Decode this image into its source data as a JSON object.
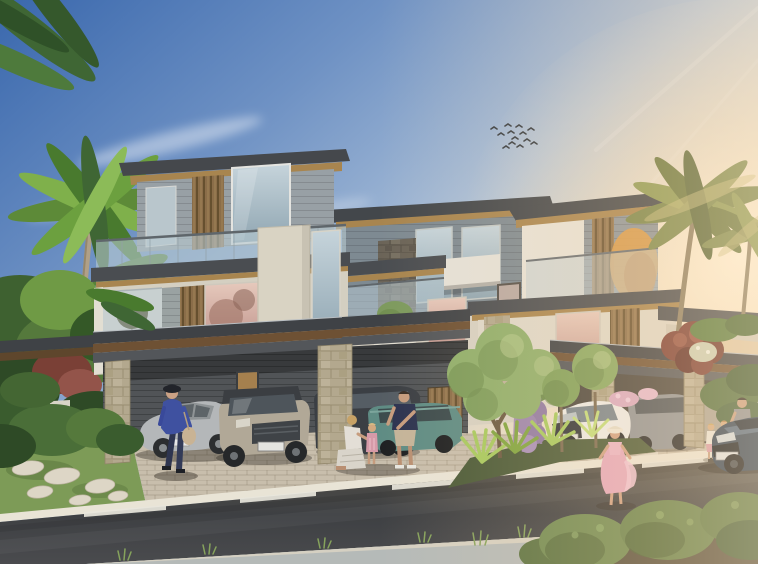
{
  "meta": {
    "type": "architectural-exterior-rendering",
    "subject": "contemporary twin luxury villas at sunset with street scene",
    "width_px": 758,
    "height_px": 564
  },
  "palette": {
    "sky-top": "#3a68ad",
    "sky-mid": "#a9bed7",
    "sky-horizon": "#f0e0c8",
    "sun-glow": "#fff3dc",
    "roof-dark": "#43474b",
    "fascia-dark": "#4a4d51",
    "soffit-wood": "#a8854f",
    "soffit-dark": "#6e5134",
    "wall-panel": "#98a0a5",
    "wall-bluegrey": "#7e8a92",
    "wall-cream": "#d4cfc1",
    "wall-white": "#e6e2d7",
    "louver-wood": "#8a6d49",
    "stone-beige": "#b3a88e",
    "stone-dark": "#6b6458",
    "balustrade-glass": "#b7c9d1",
    "frosted-glass": "#c6cfd2",
    "carport-wall": "#515457",
    "carport-warm": "#4a463f",
    "door-lit": "#a5804e",
    "paver": "#c8beac",
    "curb": "#e9e4d6",
    "grass": "#7d9b57",
    "stepping-stone": "#ddd6c6",
    "road-mark": "#e8e6dc",
    "sidewalk-far": "#b5bab8",
    "soil-dark": "#57503f",
    "palm-bright": "#7fb04b",
    "palm-mid": "#5d8a38",
    "palm-dark": "#3f6634",
    "palm-warm": "#8c9a55",
    "palm-rim": "#c7bd7e",
    "trunk-left": "#b0a087",
    "trunk-right": "#8d7f63",
    "bush-dark": "#3a5c2e",
    "bush-mid": "#4a6e38",
    "bush-light": "#55793c",
    "shrub-red": "#7a3c33",
    "topiary": "#8fae6b",
    "topiary-dark": "#6d8c4d",
    "ball-tree": "#7fa05a",
    "wisteria": "#8f79a3",
    "spiky-green": "#a6c95e",
    "flower-pink": "#d9a9c2",
    "car-silver": "#b4b7b9",
    "car-beige": "#b1a897",
    "car-dark": "#3b3f44",
    "car-teal": "#5f8c84",
    "car-white": "#ebebe8",
    "car-grey": "#8e9296",
    "car-blue": "#2c3e52",
    "skin": "#caa184",
    "outfit-blue": "#3f51a0",
    "outfit-navy": "#2c3350",
    "outfit-grey": "#8a8d92",
    "outfit-khaki": "#c4b49a",
    "dress-white": "#e3ded6",
    "dress-pink": "#e4a7bc",
    "bird": "#343a40"
  },
  "scene": {
    "sky": {
      "time_of_day": "sunset",
      "bird_count": 13,
      "clouds": "wispy diagonal streaks upper-left",
      "sun_position": "right of frame"
    },
    "building": {
      "style": "modern flat-roof villas",
      "visible_floors": 3,
      "features": [
        "dark roof slabs with wood soffits",
        "glass balustrade terraces",
        "vertical timber louvers",
        "stacked-stone piers",
        "warm-lit interiors",
        "double carports"
      ]
    },
    "vehicles": [
      {
        "name": "silver sedan",
        "location": "left carport"
      },
      {
        "name": "beige compact SUV",
        "location": "left carport"
      },
      {
        "name": "dark grey SUV",
        "location": "left carport"
      },
      {
        "name": "teal estate car",
        "location": "driveway centre"
      },
      {
        "name": "white crossover",
        "location": "right driveway"
      },
      {
        "name": "grey SUV",
        "location": "right carport"
      },
      {
        "name": "dark blue coupe",
        "location": "road, right"
      }
    ],
    "people": [
      {
        "name": "woman walking with handbag",
        "location": "left sidewalk"
      },
      {
        "name": "kneeling woman",
        "location": "centre driveway"
      },
      {
        "name": "child in pink overalls",
        "location": "centre driveway"
      },
      {
        "name": "man in navy t-shirt",
        "location": "centre driveway"
      },
      {
        "name": "woman in pink dress and sun hat",
        "location": "right sidewalk"
      },
      {
        "name": "man with two children",
        "location": "right carport"
      }
    ],
    "landscaping": [
      "left palm cluster",
      "right backlit palms",
      "sculpted topiary tree",
      "ball topiaries",
      "purple wisteria",
      "red shrub",
      "round foreground bushes",
      "grass verge with stepping stones"
    ],
    "road": {
      "surface": "asphalt",
      "lane_dash_count": 5
    }
  }
}
